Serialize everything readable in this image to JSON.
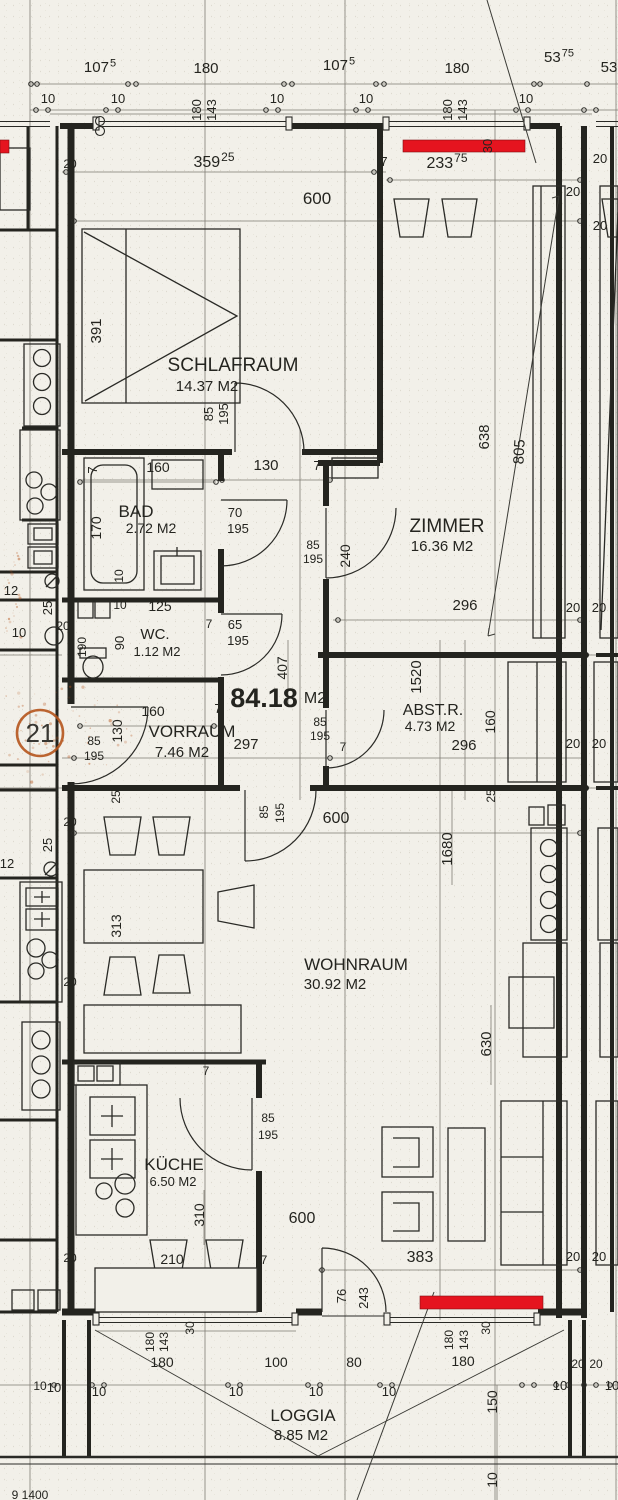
{
  "plan_type": "Grundriss Wohnung",
  "total_area": {
    "value": "84.18",
    "unit": "M2",
    "x": 264,
    "y": 707,
    "unit_x": 315,
    "unit_y": 703
  },
  "unit_marker": {
    "value": "21",
    "x": 40,
    "y": 742,
    "cx": 40,
    "cy": 733,
    "r": 23,
    "color": "#b5541c"
  },
  "colors": {
    "line": "#24241f",
    "thin": "#6b685f",
    "red": "#e5141f",
    "red_dark": "#7e0d12",
    "orange": "#b5541c",
    "paper": "#f2f0e9"
  },
  "rooms": [
    {
      "name": "SCHLAFRAUM",
      "area": "14.37 M2",
      "nx": 233,
      "ny": 371,
      "ax": 207,
      "ay": 391,
      "ns": 19,
      "as": 15
    },
    {
      "name": "ZIMMER",
      "area": "16.36 M2",
      "nx": 447,
      "ny": 532,
      "ax": 442,
      "ay": 551,
      "ns": 19,
      "as": 15
    },
    {
      "name": "BAD",
      "area": "2.72 M2",
      "nx": 136,
      "ny": 517,
      "ax": 151,
      "ay": 533,
      "ns": 17,
      "as": 14
    },
    {
      "name": "WC.",
      "area": "1.12 M2",
      "nx": 155,
      "ny": 639,
      "ax": 157,
      "ay": 656,
      "ns": 15,
      "as": 13
    },
    {
      "name": "VORRAUM",
      "area": "7.46 M2",
      "nx": 192,
      "ny": 737,
      "ax": 182,
      "ay": 757,
      "ns": 17,
      "as": 15
    },
    {
      "name": "ABST.R.",
      "area": "4.73 M2",
      "nx": 433,
      "ny": 715,
      "ax": 430,
      "ay": 731,
      "ns": 16,
      "as": 14
    },
    {
      "name": "WOHNRAUM",
      "area": "30.92 M2",
      "nx": 356,
      "ny": 970,
      "ax": 335,
      "ay": 989,
      "ns": 17,
      "as": 15
    },
    {
      "name": "KÜCHE",
      "area": "6.50 M2",
      "nx": 174,
      "ny": 1170,
      "ax": 173,
      "ay": 1186,
      "ns": 17,
      "as": 13
    },
    {
      "name": "LOGGIA",
      "area": "8.85 M2",
      "nx": 303,
      "ny": 1421,
      "ax": 301,
      "ay": 1440,
      "ns": 17,
      "as": 15
    }
  ],
  "dims": [
    {
      "t": "107",
      "sup": "5",
      "x": 100,
      "y": 72,
      "s": 15
    },
    {
      "t": "180",
      "x": 206,
      "y": 73,
      "s": 15
    },
    {
      "t": "107",
      "sup": "5",
      "x": 339,
      "y": 70,
      "s": 15
    },
    {
      "t": "180",
      "x": 457,
      "y": 73,
      "s": 15
    },
    {
      "t": "53",
      "sup": "75",
      "x": 559,
      "y": 62,
      "s": 15
    },
    {
      "t": "53",
      "x": 609,
      "y": 72,
      "s": 15
    },
    {
      "t": "10",
      "x": 48,
      "y": 103,
      "s": 13
    },
    {
      "t": "10",
      "x": 118,
      "y": 103,
      "s": 13
    },
    {
      "t": "180",
      "x": 201,
      "y": 110,
      "r": -90,
      "s": 13
    },
    {
      "t": "143",
      "x": 216,
      "y": 110,
      "r": -90,
      "s": 13
    },
    {
      "t": "10",
      "x": 277,
      "y": 103,
      "s": 13
    },
    {
      "t": "10",
      "x": 366,
      "y": 103,
      "s": 13
    },
    {
      "t": "180",
      "x": 452,
      "y": 110,
      "r": -90,
      "s": 13
    },
    {
      "t": "143",
      "x": 467,
      "y": 110,
      "r": -90,
      "s": 13
    },
    {
      "t": "10",
      "x": 526,
      "y": 103,
      "s": 13
    },
    {
      "t": "20",
      "x": 70,
      "y": 168,
      "s": 12
    },
    {
      "t": "20",
      "x": 600,
      "y": 163,
      "s": 13
    },
    {
      "t": "20",
      "x": 573,
      "y": 196,
      "s": 13
    },
    {
      "t": "20",
      "x": 600,
      "y": 230,
      "s": 13
    },
    {
      "t": "30",
      "x": 492,
      "y": 146,
      "r": -90,
      "s": 13
    },
    {
      "t": "359",
      "sup": "25",
      "x": 214,
      "y": 167,
      "s": 16
    },
    {
      "t": "7",
      "x": 384,
      "y": 166,
      "s": 13
    },
    {
      "t": "233",
      "sup": "75",
      "x": 447,
      "y": 168,
      "s": 16
    },
    {
      "t": "600",
      "x": 317,
      "y": 204,
      "s": 17
    },
    {
      "t": "391",
      "x": 101,
      "y": 331,
      "r": -90,
      "s": 15
    },
    {
      "t": "638",
      "x": 489,
      "y": 437,
      "r": -90,
      "s": 15
    },
    {
      "t": "805",
      "x": 524,
      "y": 452,
      "r": -87,
      "s": 15
    },
    {
      "t": "85",
      "x": 213,
      "y": 414,
      "r": -90,
      "s": 13
    },
    {
      "t": "195",
      "x": 228,
      "y": 414,
      "r": -90,
      "s": 13
    },
    {
      "t": "7",
      "x": 97,
      "y": 470,
      "r": -90,
      "s": 13
    },
    {
      "t": "7",
      "x": 221,
      "y": 470,
      "s": 13
    },
    {
      "t": "130",
      "x": 266,
      "y": 470,
      "s": 15
    },
    {
      "t": "7",
      "x": 317,
      "y": 470,
      "s": 13
    },
    {
      "t": "160",
      "x": 158,
      "y": 472,
      "s": 14
    },
    {
      "t": "170",
      "x": 101,
      "y": 528,
      "r": -90,
      "s": 14
    },
    {
      "t": "70",
      "x": 235,
      "y": 517,
      "s": 13
    },
    {
      "t": "195",
      "x": 238,
      "y": 533,
      "s": 13
    },
    {
      "t": "85",
      "x": 313,
      "y": 549,
      "s": 12
    },
    {
      "t": "195",
      "x": 313,
      "y": 563,
      "s": 12
    },
    {
      "t": "240",
      "x": 350,
      "y": 556,
      "r": -90,
      "s": 14
    },
    {
      "t": "10",
      "x": 123,
      "y": 576,
      "r": -90,
      "s": 12
    },
    {
      "t": "125",
      "x": 160,
      "y": 611,
      "s": 14
    },
    {
      "t": "10",
      "x": 120,
      "y": 609,
      "s": 12
    },
    {
      "t": "65",
      "x": 235,
      "y": 629,
      "s": 13
    },
    {
      "t": "195",
      "x": 238,
      "y": 645,
      "s": 13
    },
    {
      "t": "7",
      "x": 209,
      "y": 628,
      "s": 12
    },
    {
      "t": "90",
      "x": 124,
      "y": 643,
      "r": -90,
      "s": 13
    },
    {
      "t": "190",
      "x": 86,
      "y": 647,
      "r": -90,
      "s": 12
    },
    {
      "t": "296",
      "x": 465,
      "y": 610,
      "s": 15
    },
    {
      "t": "20",
      "x": 573,
      "y": 612,
      "s": 13
    },
    {
      "t": "20",
      "x": 599,
      "y": 612,
      "s": 13
    },
    {
      "t": "1520",
      "x": 421,
      "y": 677,
      "r": -90,
      "s": 15
    },
    {
      "t": "407",
      "x": 287,
      "y": 668,
      "r": -90,
      "s": 14
    },
    {
      "t": "160",
      "x": 153,
      "y": 716,
      "s": 14
    },
    {
      "t": "7",
      "x": 218,
      "y": 713,
      "s": 13
    },
    {
      "t": "297",
      "x": 246,
      "y": 749,
      "s": 15
    },
    {
      "t": "130",
      "x": 122,
      "y": 731,
      "r": -90,
      "s": 14
    },
    {
      "t": "85",
      "x": 94,
      "y": 745,
      "s": 12
    },
    {
      "t": "195",
      "x": 94,
      "y": 760,
      "s": 12
    },
    {
      "t": "160",
      "x": 495,
      "y": 722,
      "r": -90,
      "s": 14
    },
    {
      "t": "296",
      "x": 464,
      "y": 750,
      "s": 15
    },
    {
      "t": "85",
      "x": 320,
      "y": 726,
      "s": 12
    },
    {
      "t": "195",
      "x": 320,
      "y": 740,
      "s": 12
    },
    {
      "t": "7",
      "x": 343,
      "y": 751,
      "s": 12
    },
    {
      "t": "20",
      "x": 573,
      "y": 748,
      "s": 13
    },
    {
      "t": "20",
      "x": 599,
      "y": 748,
      "s": 13
    },
    {
      "t": "25",
      "x": 120,
      "y": 797,
      "r": -90,
      "s": 12
    },
    {
      "t": "25",
      "x": 495,
      "y": 796,
      "r": -90,
      "s": 12
    },
    {
      "t": "85",
      "x": 268,
      "y": 812,
      "r": -90,
      "s": 12
    },
    {
      "t": "195",
      "x": 284,
      "y": 813,
      "r": -90,
      "s": 12
    },
    {
      "t": "600",
      "x": 336,
      "y": 823,
      "s": 16
    },
    {
      "t": "1680",
      "x": 452,
      "y": 849,
      "r": -90,
      "s": 15
    },
    {
      "t": "20",
      "x": 70,
      "y": 826,
      "s": 12
    },
    {
      "t": "313",
      "x": 121,
      "y": 926,
      "r": -90,
      "s": 14
    },
    {
      "t": "20",
      "x": 70,
      "y": 986,
      "s": 12
    },
    {
      "t": "630",
      "x": 491,
      "y": 1044,
      "r": -90,
      "s": 15
    },
    {
      "t": "20",
      "x": 573,
      "y": 1261,
      "s": 13
    },
    {
      "t": "20",
      "x": 599,
      "y": 1261,
      "s": 13
    },
    {
      "t": "7",
      "x": 206,
      "y": 1075,
      "s": 12
    },
    {
      "t": "85",
      "x": 268,
      "y": 1122,
      "s": 12
    },
    {
      "t": "195",
      "x": 268,
      "y": 1139,
      "s": 12
    },
    {
      "t": "310",
      "x": 204,
      "y": 1215,
      "r": -90,
      "s": 14
    },
    {
      "t": "600",
      "x": 302,
      "y": 1223,
      "s": 16
    },
    {
      "t": "210",
      "x": 172,
      "y": 1264,
      "s": 14
    },
    {
      "t": "7",
      "x": 264,
      "y": 1264,
      "s": 12
    },
    {
      "t": "20",
      "x": 70,
      "y": 1262,
      "s": 12
    },
    {
      "t": "383",
      "x": 420,
      "y": 1262,
      "s": 16
    },
    {
      "t": "76",
      "x": 346,
      "y": 1296,
      "r": -90,
      "s": 13
    },
    {
      "t": "243",
      "x": 368,
      "y": 1298,
      "r": -90,
      "s": 13
    },
    {
      "t": "30",
      "x": 194,
      "y": 1328,
      "r": -90,
      "s": 12
    },
    {
      "t": "30",
      "x": 490,
      "y": 1328,
      "r": -90,
      "s": 12
    },
    {
      "t": "180",
      "x": 154,
      "y": 1342,
      "r": -90,
      "s": 12
    },
    {
      "t": "143",
      "x": 168,
      "y": 1342,
      "r": -90,
      "s": 12
    },
    {
      "t": "180",
      "x": 453,
      "y": 1340,
      "r": -90,
      "s": 12
    },
    {
      "t": "143",
      "x": 468,
      "y": 1340,
      "r": -90,
      "s": 12
    },
    {
      "t": "180",
      "x": 162,
      "y": 1367,
      "s": 14
    },
    {
      "t": "100",
      "x": 276,
      "y": 1367,
      "s": 14
    },
    {
      "t": "80",
      "x": 354,
      "y": 1367,
      "s": 14
    },
    {
      "t": "180",
      "x": 463,
      "y": 1366,
      "s": 14
    },
    {
      "t": "10",
      "x": 54,
      "y": 1392,
      "s": 13
    },
    {
      "t": "10",
      "x": 99,
      "y": 1396,
      "s": 13
    },
    {
      "t": "10",
      "x": 236,
      "y": 1396,
      "s": 13
    },
    {
      "t": "10",
      "x": 316,
      "y": 1396,
      "s": 13
    },
    {
      "t": "10",
      "x": 389,
      "y": 1396,
      "s": 13
    },
    {
      "t": "20",
      "x": 578,
      "y": 1368,
      "s": 12
    },
    {
      "t": "20",
      "x": 596,
      "y": 1368,
      "s": 12
    },
    {
      "t": "10",
      "x": 560,
      "y": 1390,
      "s": 13
    },
    {
      "t": "10",
      "x": 612,
      "y": 1390,
      "s": 13
    },
    {
      "t": "150",
      "x": 497,
      "y": 1402,
      "r": -90,
      "s": 14
    },
    {
      "t": "10",
      "x": 497,
      "y": 1480,
      "r": -90,
      "s": 14
    },
    {
      "t": "12",
      "x": 11,
      "y": 595,
      "s": 13
    },
    {
      "t": "25",
      "x": 52,
      "y": 608,
      "r": -90,
      "s": 13
    },
    {
      "t": "10",
      "x": 19,
      "y": 637,
      "s": 13
    },
    {
      "t": "20",
      "x": 63,
      "y": 630,
      "s": 12
    },
    {
      "t": "25",
      "x": 52,
      "y": 845,
      "r": -90,
      "s": 13
    },
    {
      "t": "12",
      "x": 7,
      "y": 868,
      "s": 13
    },
    {
      "t": "10",
      "x": 40,
      "y": 1390,
      "s": 12
    },
    {
      "t": "9 1400",
      "x": 30,
      "y": 1499,
      "s": 12
    }
  ]
}
